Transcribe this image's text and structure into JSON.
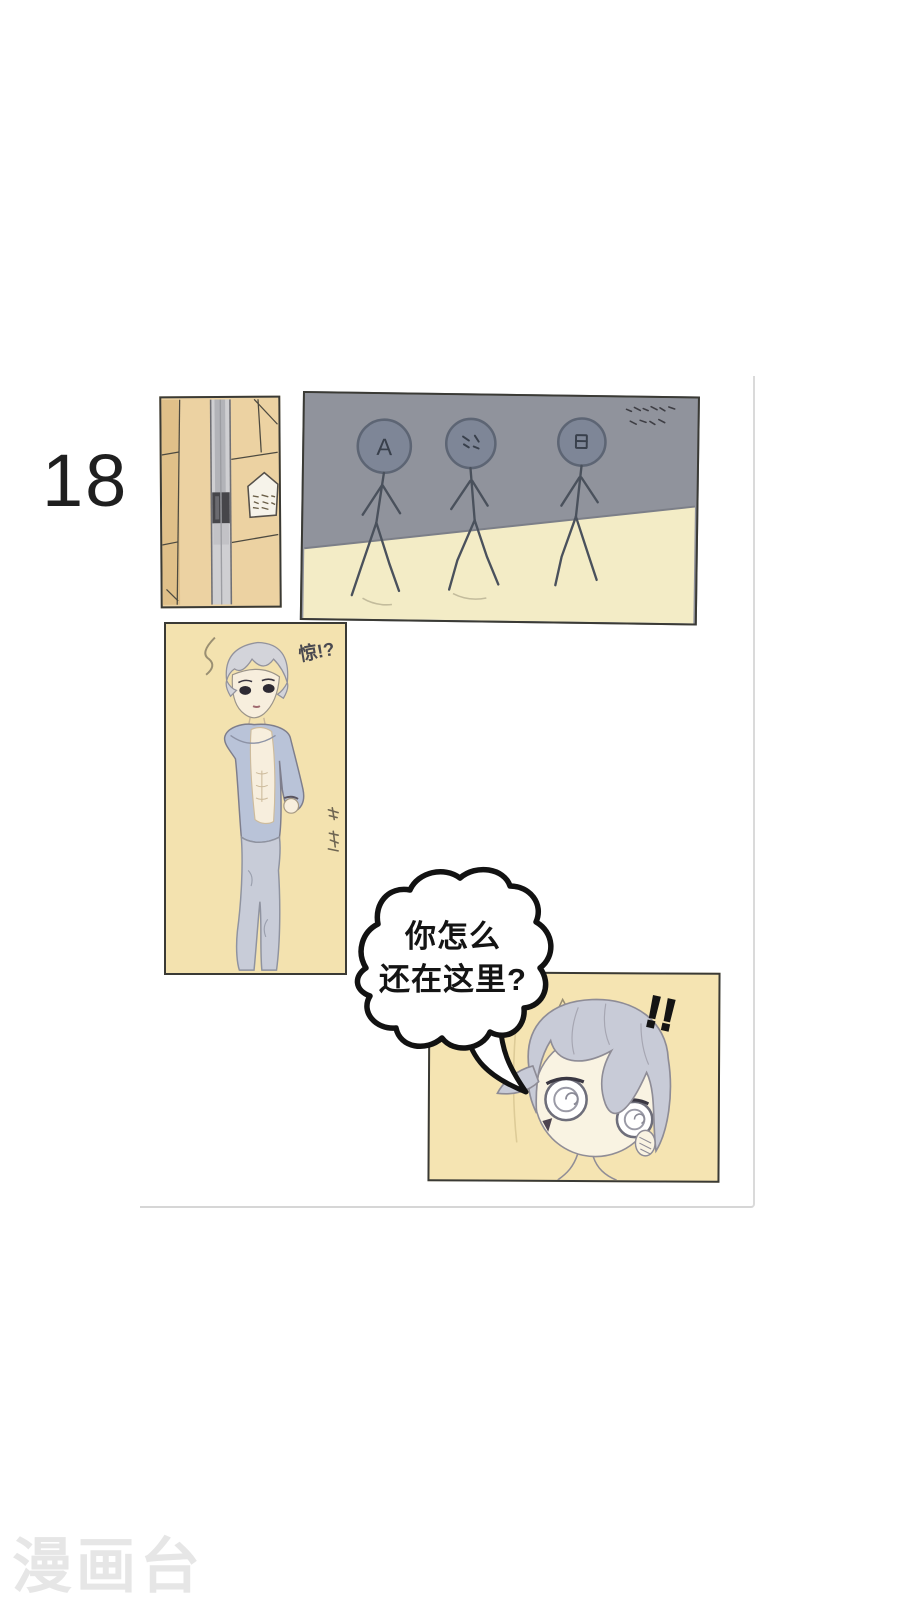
{
  "app": {
    "type": "comic-reader-page"
  },
  "page": {
    "number": "18"
  },
  "watermark": {
    "text": "漫画台"
  },
  "speech_bubble": {
    "line1": "你怎么",
    "line2": "还在这里?"
  },
  "annotations": {
    "startled": "惊!?",
    "exclamation": "!!"
  },
  "stick_figures": {
    "label_a": "A"
  },
  "colors": {
    "background": "#ffffff",
    "page_edge": "#d9d9d9",
    "panel_border": "#3a3a35",
    "wall_gray": "#90939c",
    "floor_cream": "#f3ecc6",
    "tile_tan": "#ecd2a2",
    "panel_cream": "#f3e2af",
    "stick_head": "#7e8697",
    "hair_gray": "#d3d4da",
    "outfit_blue": "#b9c3d8",
    "girl_hair": "#c8cbd7",
    "skin_cream": "#f7eedd",
    "bubble_outline": "#121212",
    "watermark_gray": "#e6e6e6"
  }
}
